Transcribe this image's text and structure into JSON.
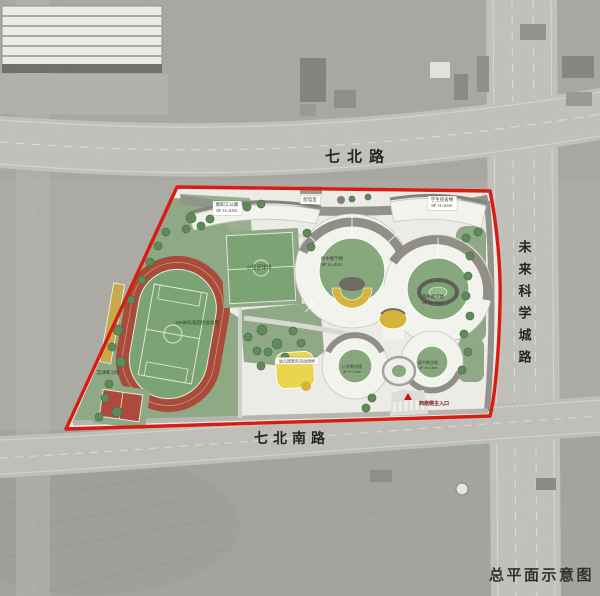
{
  "page": {
    "caption": "总平面示意图"
  },
  "roads": {
    "north": "七北路",
    "south": "七北南路",
    "east": "未来科学城路"
  },
  "site_labels": {
    "staff_apartment": "教职工公寓\n6F H=24m",
    "power_room": "配电室",
    "student_dorm": "学生宿舍楼\n6F H=24m",
    "junior_building": "初中教学楼\n5F H=24m",
    "senior_building": "高中教学楼\n5F H=24m",
    "small_pitch": "小型足球场",
    "track": "400米标准田径运动场",
    "basketball": "篮球练习场",
    "kindergarten_yard": "幼儿园室外活动场地",
    "primary_building": "小学教学楼\n4F H=19m",
    "senior_building_2": "高中教学楼\n4F H=18m",
    "main_entrance": "西南侧主入口"
  },
  "colors": {
    "site_boundary": "#d91c12",
    "lawn_green": "#8fa886",
    "courtyard_green": "#87a87d",
    "track_red": "#a84b38",
    "accent_yellow": "#d9b23c",
    "road_gray": "#c2c0ba",
    "ground_light": "#ecebe6"
  }
}
